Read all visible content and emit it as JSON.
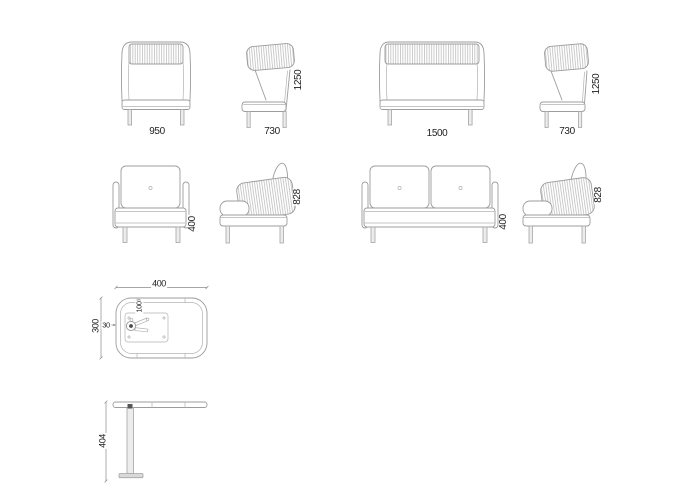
{
  "sheet": {
    "background": "#ffffff",
    "line_color": "#9c9c9c",
    "rib_color": "#b0b0b0",
    "text_color": "#1f1f1f"
  },
  "views": {
    "highback_armchair_front": {
      "width": "950"
    },
    "highback_armchair_side": {
      "depth": "730",
      "height": "1250"
    },
    "highback_sofa_front": {
      "width": "1500"
    },
    "highback_sofa_side": {
      "depth": "730",
      "height": "1250"
    },
    "lowback_armchair_front": {
      "seat_height": "400"
    },
    "lowback_armchair_side": {
      "height": "828"
    },
    "lowback_sofa_front": {
      "seat_height": "400"
    },
    "lowback_sofa_side": {
      "height": "828"
    },
    "table_top": {
      "width": "400",
      "depth": "300",
      "edge": "30",
      "inset": "100"
    },
    "table_side": {
      "height": "404"
    }
  }
}
